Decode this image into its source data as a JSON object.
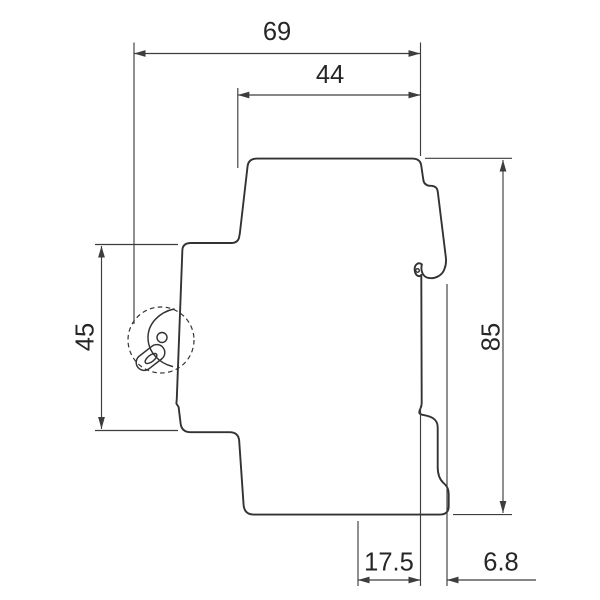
{
  "drawing": {
    "dimensions": {
      "overall_depth": {
        "value": "69"
      },
      "upper_depth": {
        "value": "44"
      },
      "front_height": {
        "value": "45"
      },
      "overall_height": {
        "value": "85"
      },
      "bottom_depth": {
        "value": "17.5"
      },
      "rear_offset": {
        "value": "6.8"
      }
    },
    "colors": {
      "outline": "#333333",
      "dimension": "#3d3d3d",
      "text": "#262626",
      "background": "#ffffff"
    }
  }
}
